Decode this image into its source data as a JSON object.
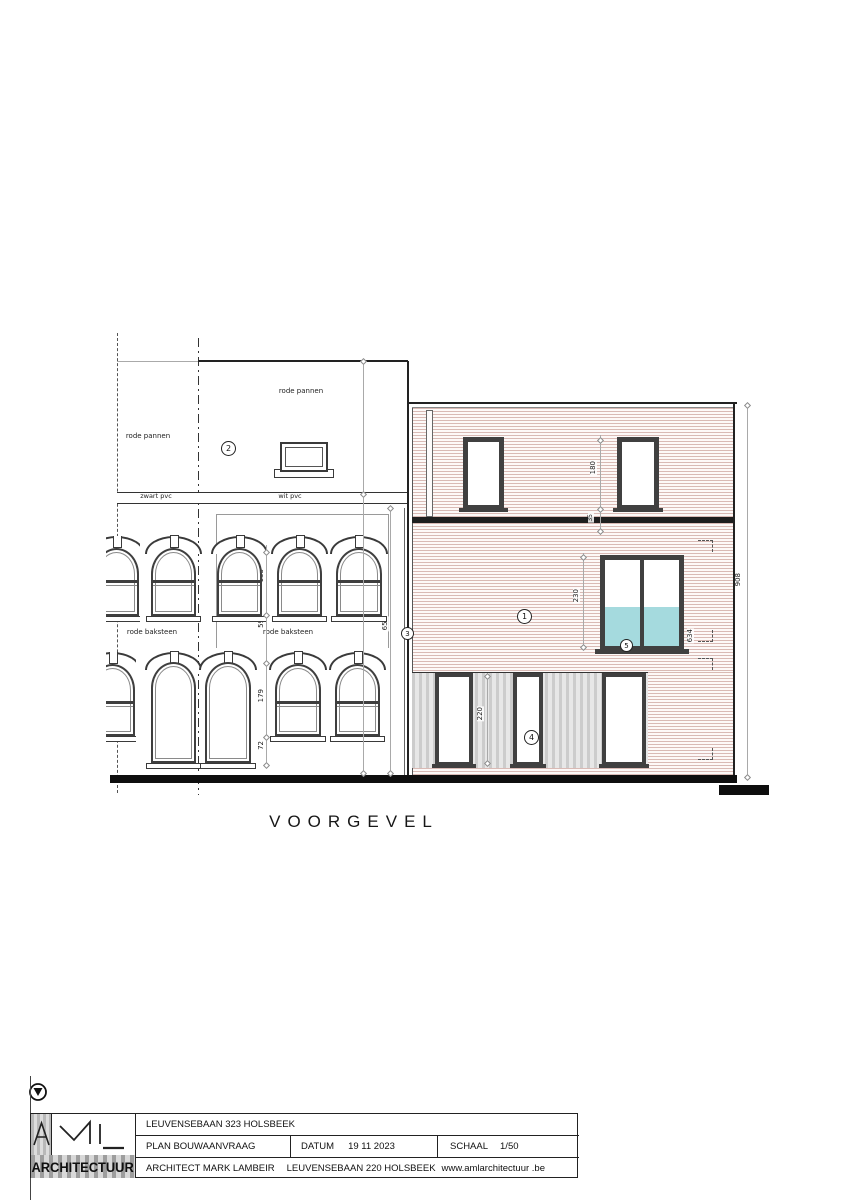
{
  "drawing": {
    "title": "VOORGEVEL",
    "labels": {
      "roof_left": "rode pannen",
      "roof_right": "rode pannen",
      "gutter_left": "zwart pvc",
      "gutter_right": "wit pvc",
      "brick_left": "rode baksteen",
      "brick_right": "rode baksteen",
      "door_left": "wit pvc",
      "door_right": "wit hout"
    },
    "bubbles": {
      "b1": "1",
      "b2": "2",
      "b3": "3",
      "b4": "4",
      "b5": "5"
    },
    "dims": {
      "win_upper_h": "155",
      "spandrel": "59",
      "win_code": "1020",
      "win_lower_h": "179",
      "sill_h": "72",
      "left_facade_h": "650",
      "door2_h": "212",
      "top_win_h": "180",
      "slab": "35",
      "mid_win_h": "230",
      "ground_door_h": "220",
      "right_detail": "634",
      "right_total_h": "908"
    },
    "colors": {
      "cladding_line": "#9e5448",
      "glass_tint": "#a5dade",
      "band_gray": "#d9d9d9"
    }
  },
  "titleblock": {
    "logo_text": "ARCHITECTUUR",
    "project": "LEUVENSEBAAN 323 HOLSBEEK",
    "plan": "PLAN BOUWAANVRAAG",
    "datum_label": "DATUM",
    "datum_value": "19 11 2023",
    "schaal_label": "SCHAAL",
    "schaal_value": "1/50",
    "architect": "ARCHITECT MARK LAMBEIR",
    "office_address": "LEUVENSEBAAN 220 HOLSBEEK",
    "website": "www.amlarchitectuur .be"
  }
}
